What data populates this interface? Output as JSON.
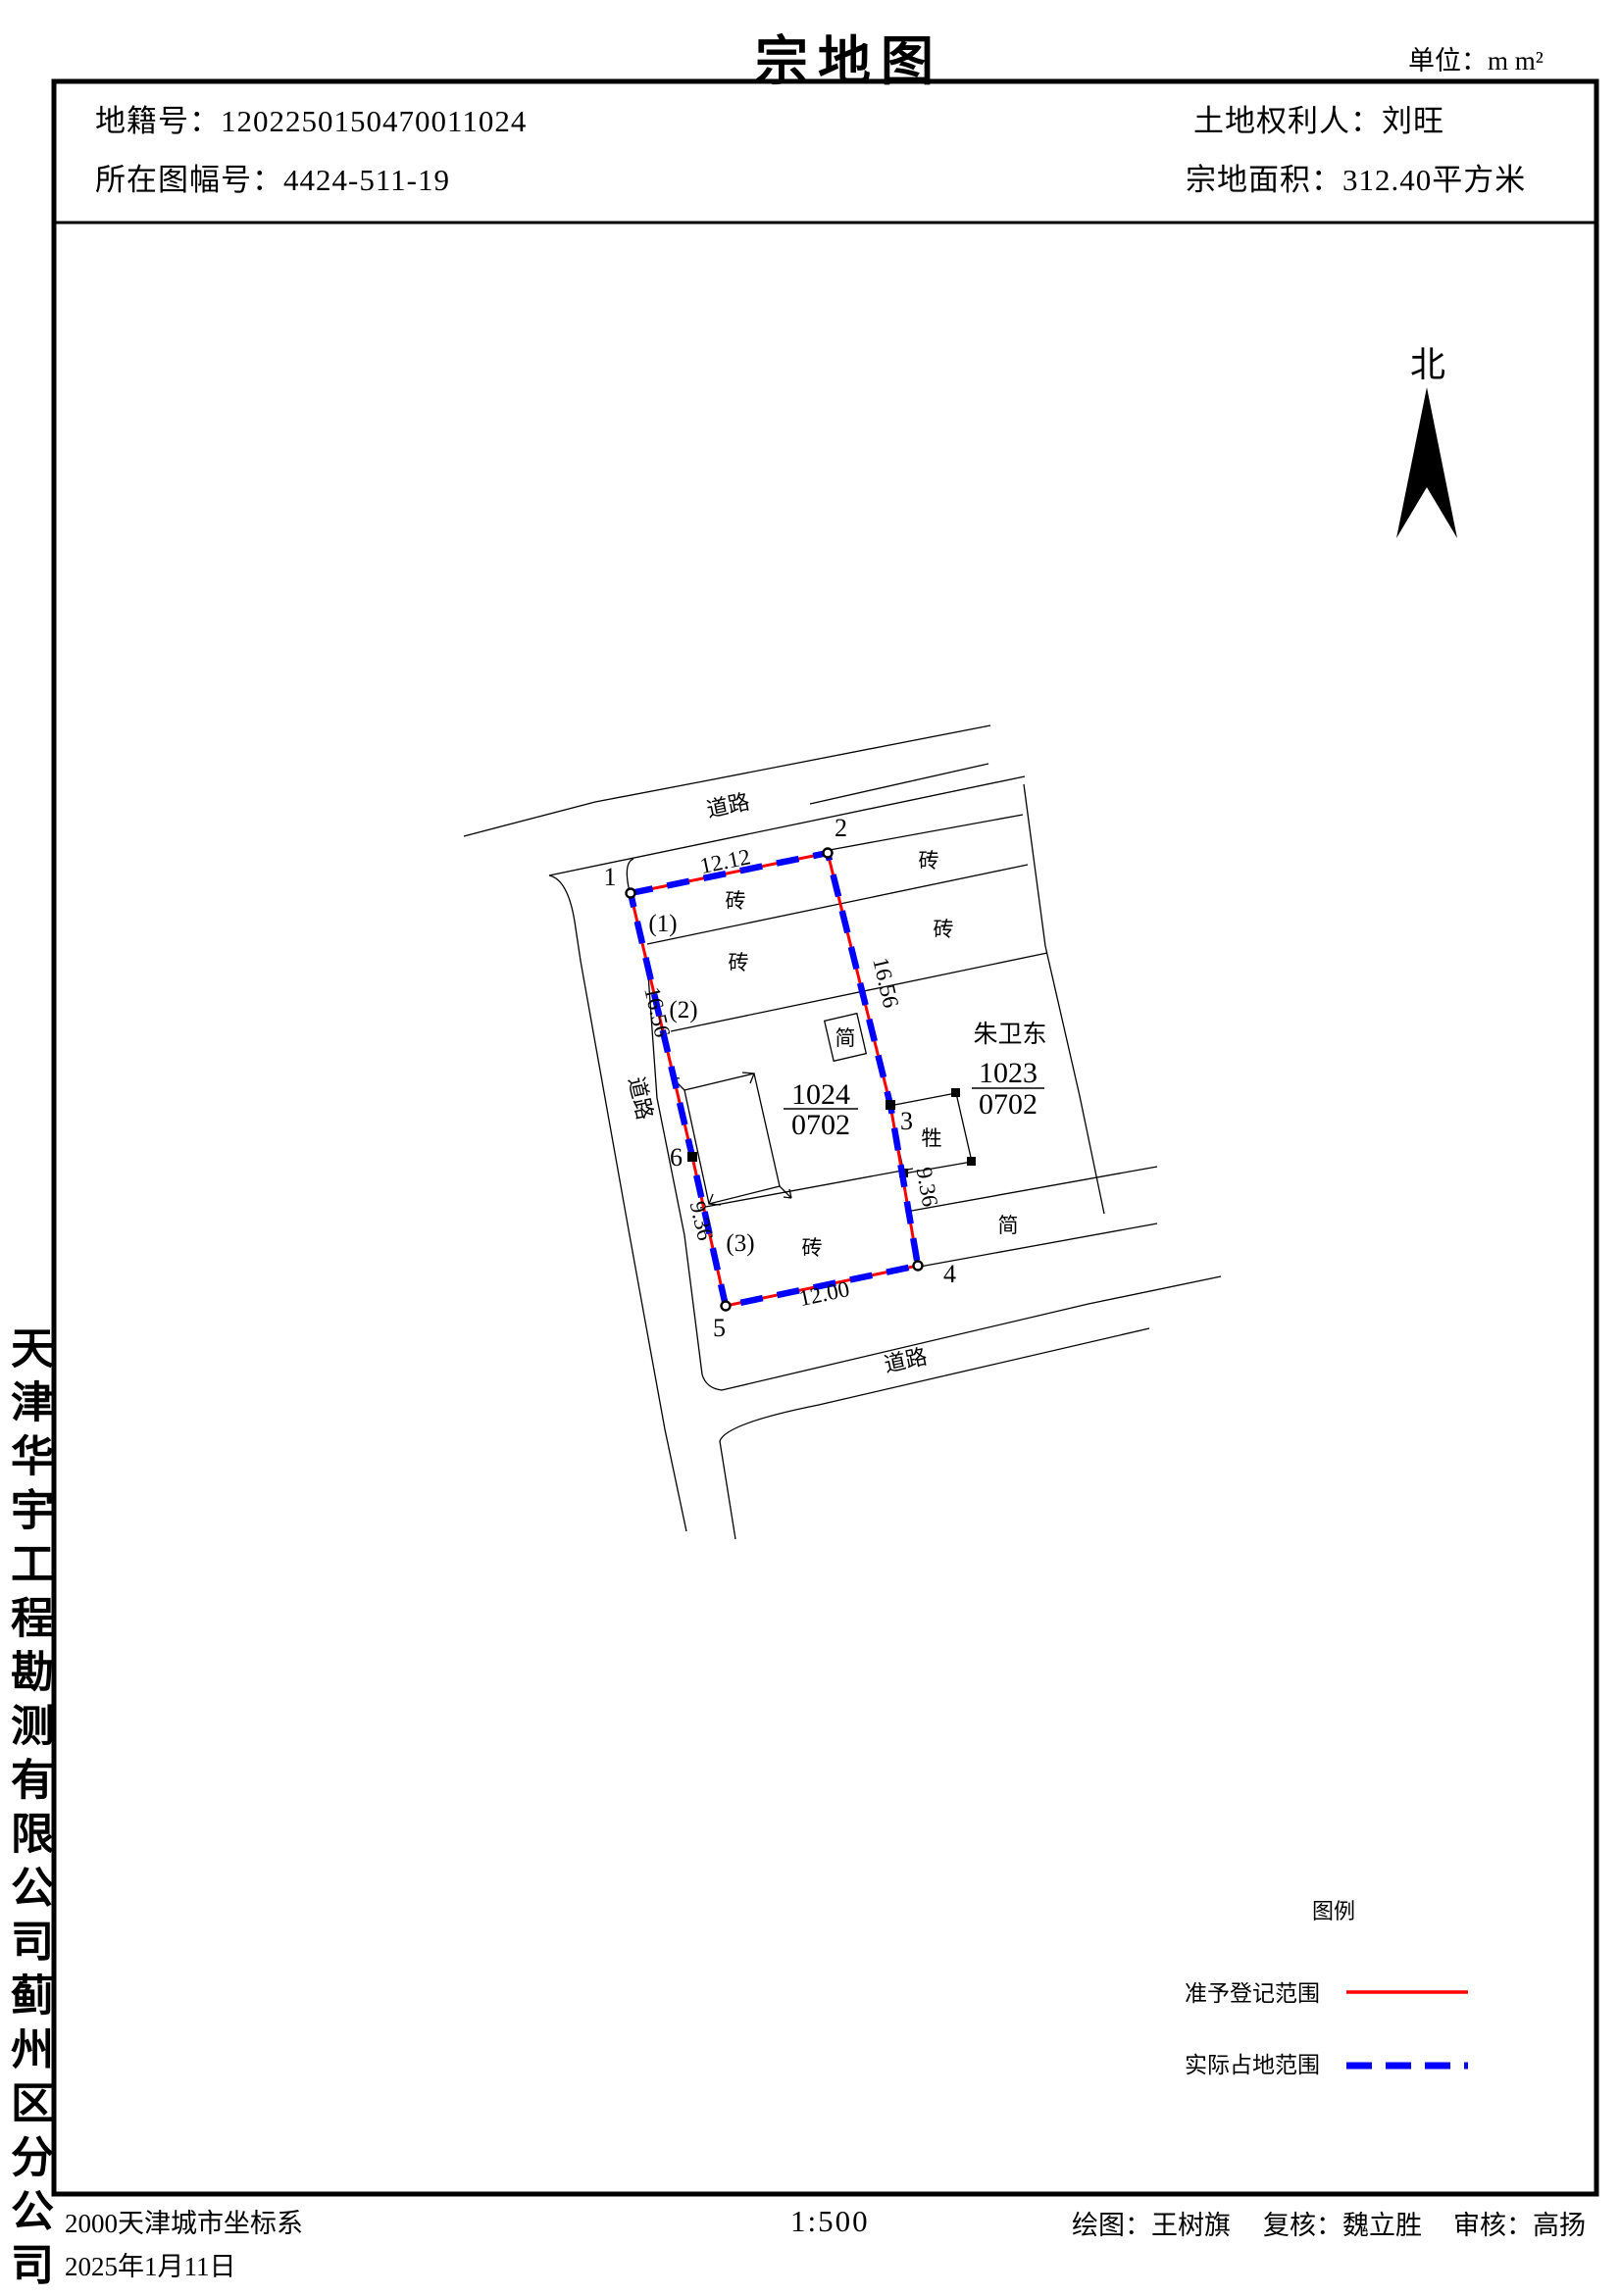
{
  "page": {
    "title": "宗地图",
    "unit_note": "单位：m  m²"
  },
  "header": {
    "cadastral_no_label": "地籍号：",
    "cadastral_no": "1202250150470011024",
    "map_sheet_label": "所在图幅号：",
    "map_sheet_no": "4424-511-19",
    "owner_label": "土地权利人：",
    "owner": "刘旺",
    "area_label": "宗地面积：",
    "area_value": "312.40平方米"
  },
  "north": {
    "label": "北"
  },
  "map": {
    "parcel": {
      "number": "1024",
      "land_class": "0702",
      "point_labels": [
        "1",
        "2",
        "3",
        "4",
        "5",
        "6"
      ],
      "dim_top": "12.12",
      "dim_left": "16.56",
      "dim_right": "16.56",
      "dim_left_lower": "9.36",
      "dim_right_lower": "9.36",
      "dim_bottom": "12.00",
      "sub_labels": [
        "(1)",
        "(2)",
        "(3)"
      ]
    },
    "neighbor": {
      "owner": "朱卫东",
      "number": "1023",
      "land_class": "0702"
    },
    "annotations": {
      "road": "道路",
      "brick": "砖",
      "simple": "简",
      "livestock": "牲"
    }
  },
  "legend": {
    "title": "图例",
    "approved_label": "准予登记范围",
    "actual_label": "实际占地范围",
    "approved_color": "#ff0000",
    "actual_color": "#0000ff"
  },
  "side": {
    "company": "天津华宇工程勘测有限公司蓟州区分公司"
  },
  "footer": {
    "crs": "2000天津城市坐标系",
    "date": "2025年1月11日",
    "scale": "1:500",
    "drawn_by": "绘图：王树旗",
    "rechecked_by": "复核：魏立胜",
    "reviewed_by": "审核：高扬"
  }
}
